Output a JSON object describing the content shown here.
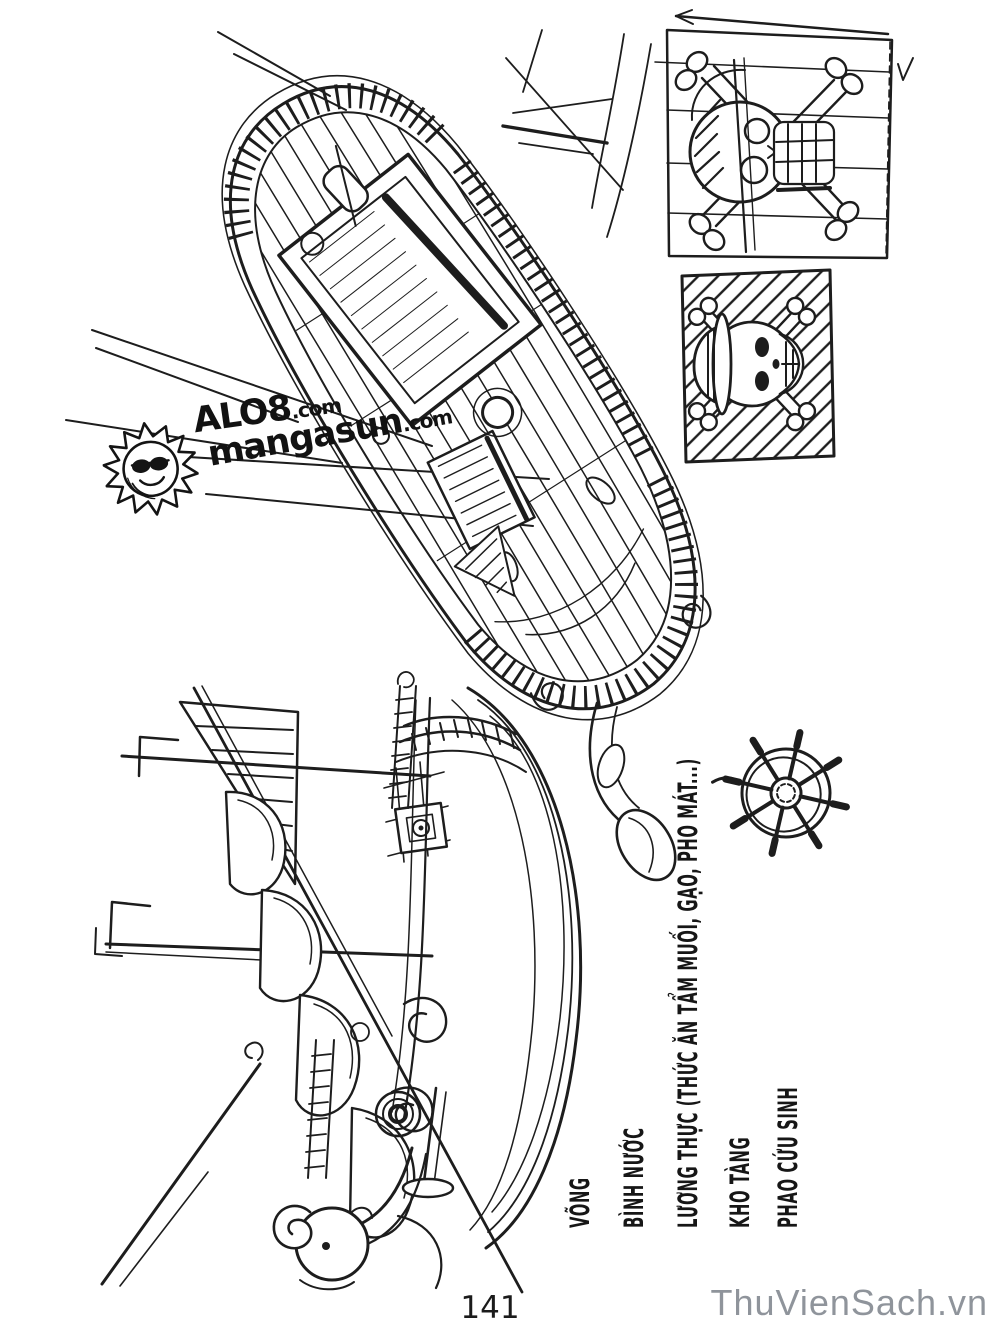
{
  "page": {
    "number": "141",
    "paper_color": "#ffffff",
    "ink_color": "#1d1d1d"
  },
  "watermarks": {
    "logo": {
      "icon": "sun-face-icon",
      "line1_brand": "ALO8",
      "line1_tld": ".com",
      "line2_brand": "mangasun",
      "line2_tld": ".com"
    },
    "site": {
      "text": "ThuVienSach.vn",
      "color": "#8f949b"
    }
  },
  "labels": {
    "items": [
      {
        "text": "VÕNG"
      },
      {
        "text": "BÌNH NƯỚC"
      },
      {
        "text": "LƯƠNG THỰC (THỨC ĂN TẨM MUỐI, GẠO, PHO MÁT...)"
      },
      {
        "text": "KHO TÀNG"
      },
      {
        "text": "PHAO CỨU SINH"
      }
    ]
  },
  "sketches": {
    "deck_plan": "ship-deck-plan-sketch",
    "side_view": "ship-side-view-sketch",
    "jolly_roger_study": "jolly-roger-study-sketch",
    "strawhat_flag": "strawhat-flag-sketch",
    "ships_wheel": "ships-wheel-sketch",
    "stern_rudder": "stern-rudder-sketch",
    "rigging": "rigging-lines-sketch"
  }
}
